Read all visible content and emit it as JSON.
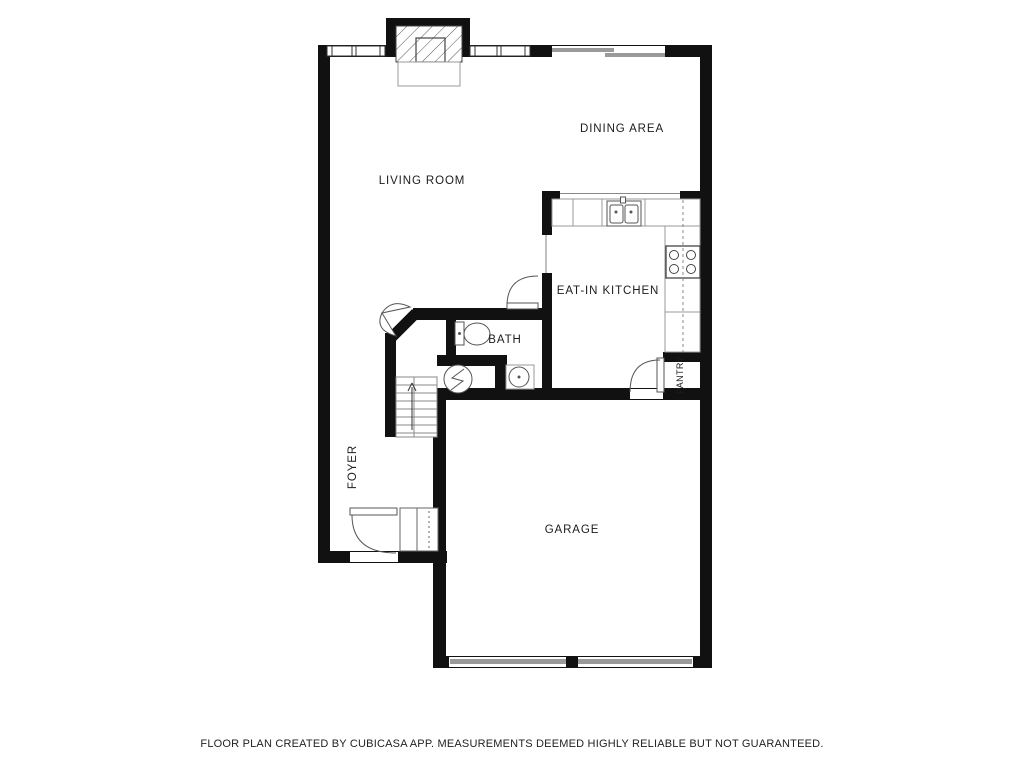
{
  "floor_plan": {
    "rooms": [
      {
        "label": "DINING AREA"
      },
      {
        "label": "LIVING ROOM"
      },
      {
        "label": "EAT-IN KITCHEN"
      },
      {
        "label": "BATH"
      },
      {
        "label": "PANTRY"
      },
      {
        "label": "FOYER"
      },
      {
        "label": "GARAGE"
      }
    ],
    "disclaimer": "FLOOR PLAN CREATED BY CUBICASA APP. MEASUREMENTS DEEMED HIGHLY RELIABLE BUT NOT GUARANTEED.",
    "colors": {
      "wall": "#111111",
      "fixture_line": "#555555",
      "counter_line": "#999999",
      "door_panel_gray": "#9a9a9a",
      "text": "#1c1c1c",
      "background": "#ffffff"
    },
    "fixtures": {
      "fireplace": "fireplace",
      "windows": "double-pane windows",
      "sliding_door": "patio sliding door",
      "kitchen_sink": "double-basin sink",
      "stove": "4-burner stove",
      "toilet": "toilet",
      "bath_sink": "bathroom sink",
      "water_heater": "water heater",
      "stairs": "staircase up",
      "entry_door": "front entry door",
      "entry_closet": "coat closet",
      "garage_door": "two-panel garage door",
      "pantry_door": "pantry door",
      "bifold_door": "bi-fold closet door"
    }
  }
}
